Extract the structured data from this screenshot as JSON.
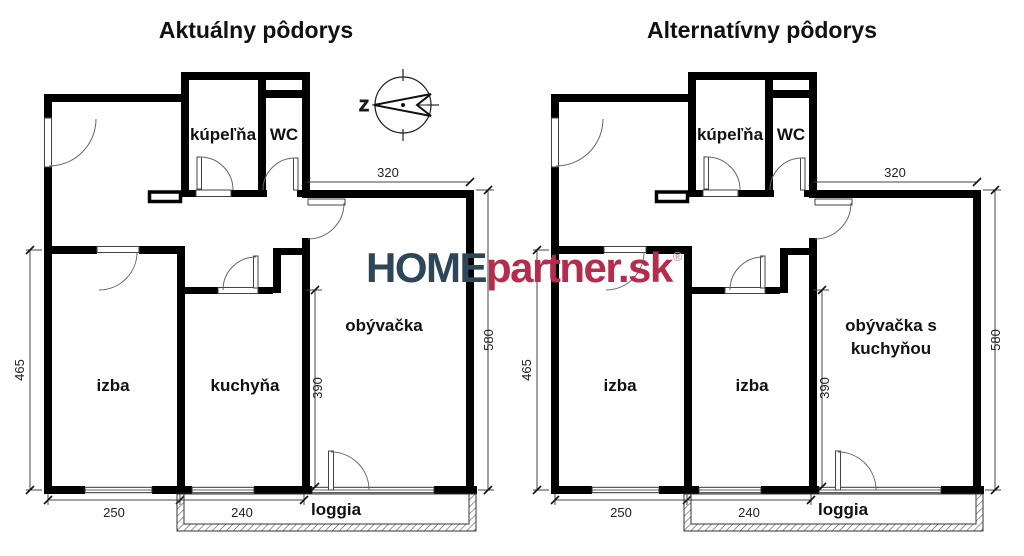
{
  "titles": {
    "left": "Aktuálny pôdorys",
    "right": "Alternatívny pôdorys"
  },
  "compass": {
    "west": "Z"
  },
  "logo": {
    "home": "HOME",
    "partner": "partner.sk",
    "registered": "®",
    "home_color": "#2d4759",
    "partner_color": "#b52c4d"
  },
  "plans": {
    "left": {
      "rooms": {
        "bathroom": "kúpeľňa",
        "wc": "WC",
        "room": "izba",
        "middle": "kuchyňa",
        "living1": "obývačka",
        "living2": "",
        "loggia": "loggia"
      },
      "dims": {
        "width_top": "320",
        "height_right": "580",
        "height_left": "465",
        "height_mid": "390",
        "width_room": "250",
        "width_kitchen": "240"
      }
    },
    "right": {
      "rooms": {
        "bathroom": "kúpeľňa",
        "wc": "WC",
        "room": "izba",
        "middle": "izba",
        "living1": "obývačka s",
        "living2": "kuchyňou",
        "loggia": "loggia"
      },
      "dims": {
        "width_top": "320",
        "height_right": "580",
        "height_left": "465",
        "height_mid": "390",
        "width_room": "250",
        "width_kitchen": "240"
      }
    }
  }
}
